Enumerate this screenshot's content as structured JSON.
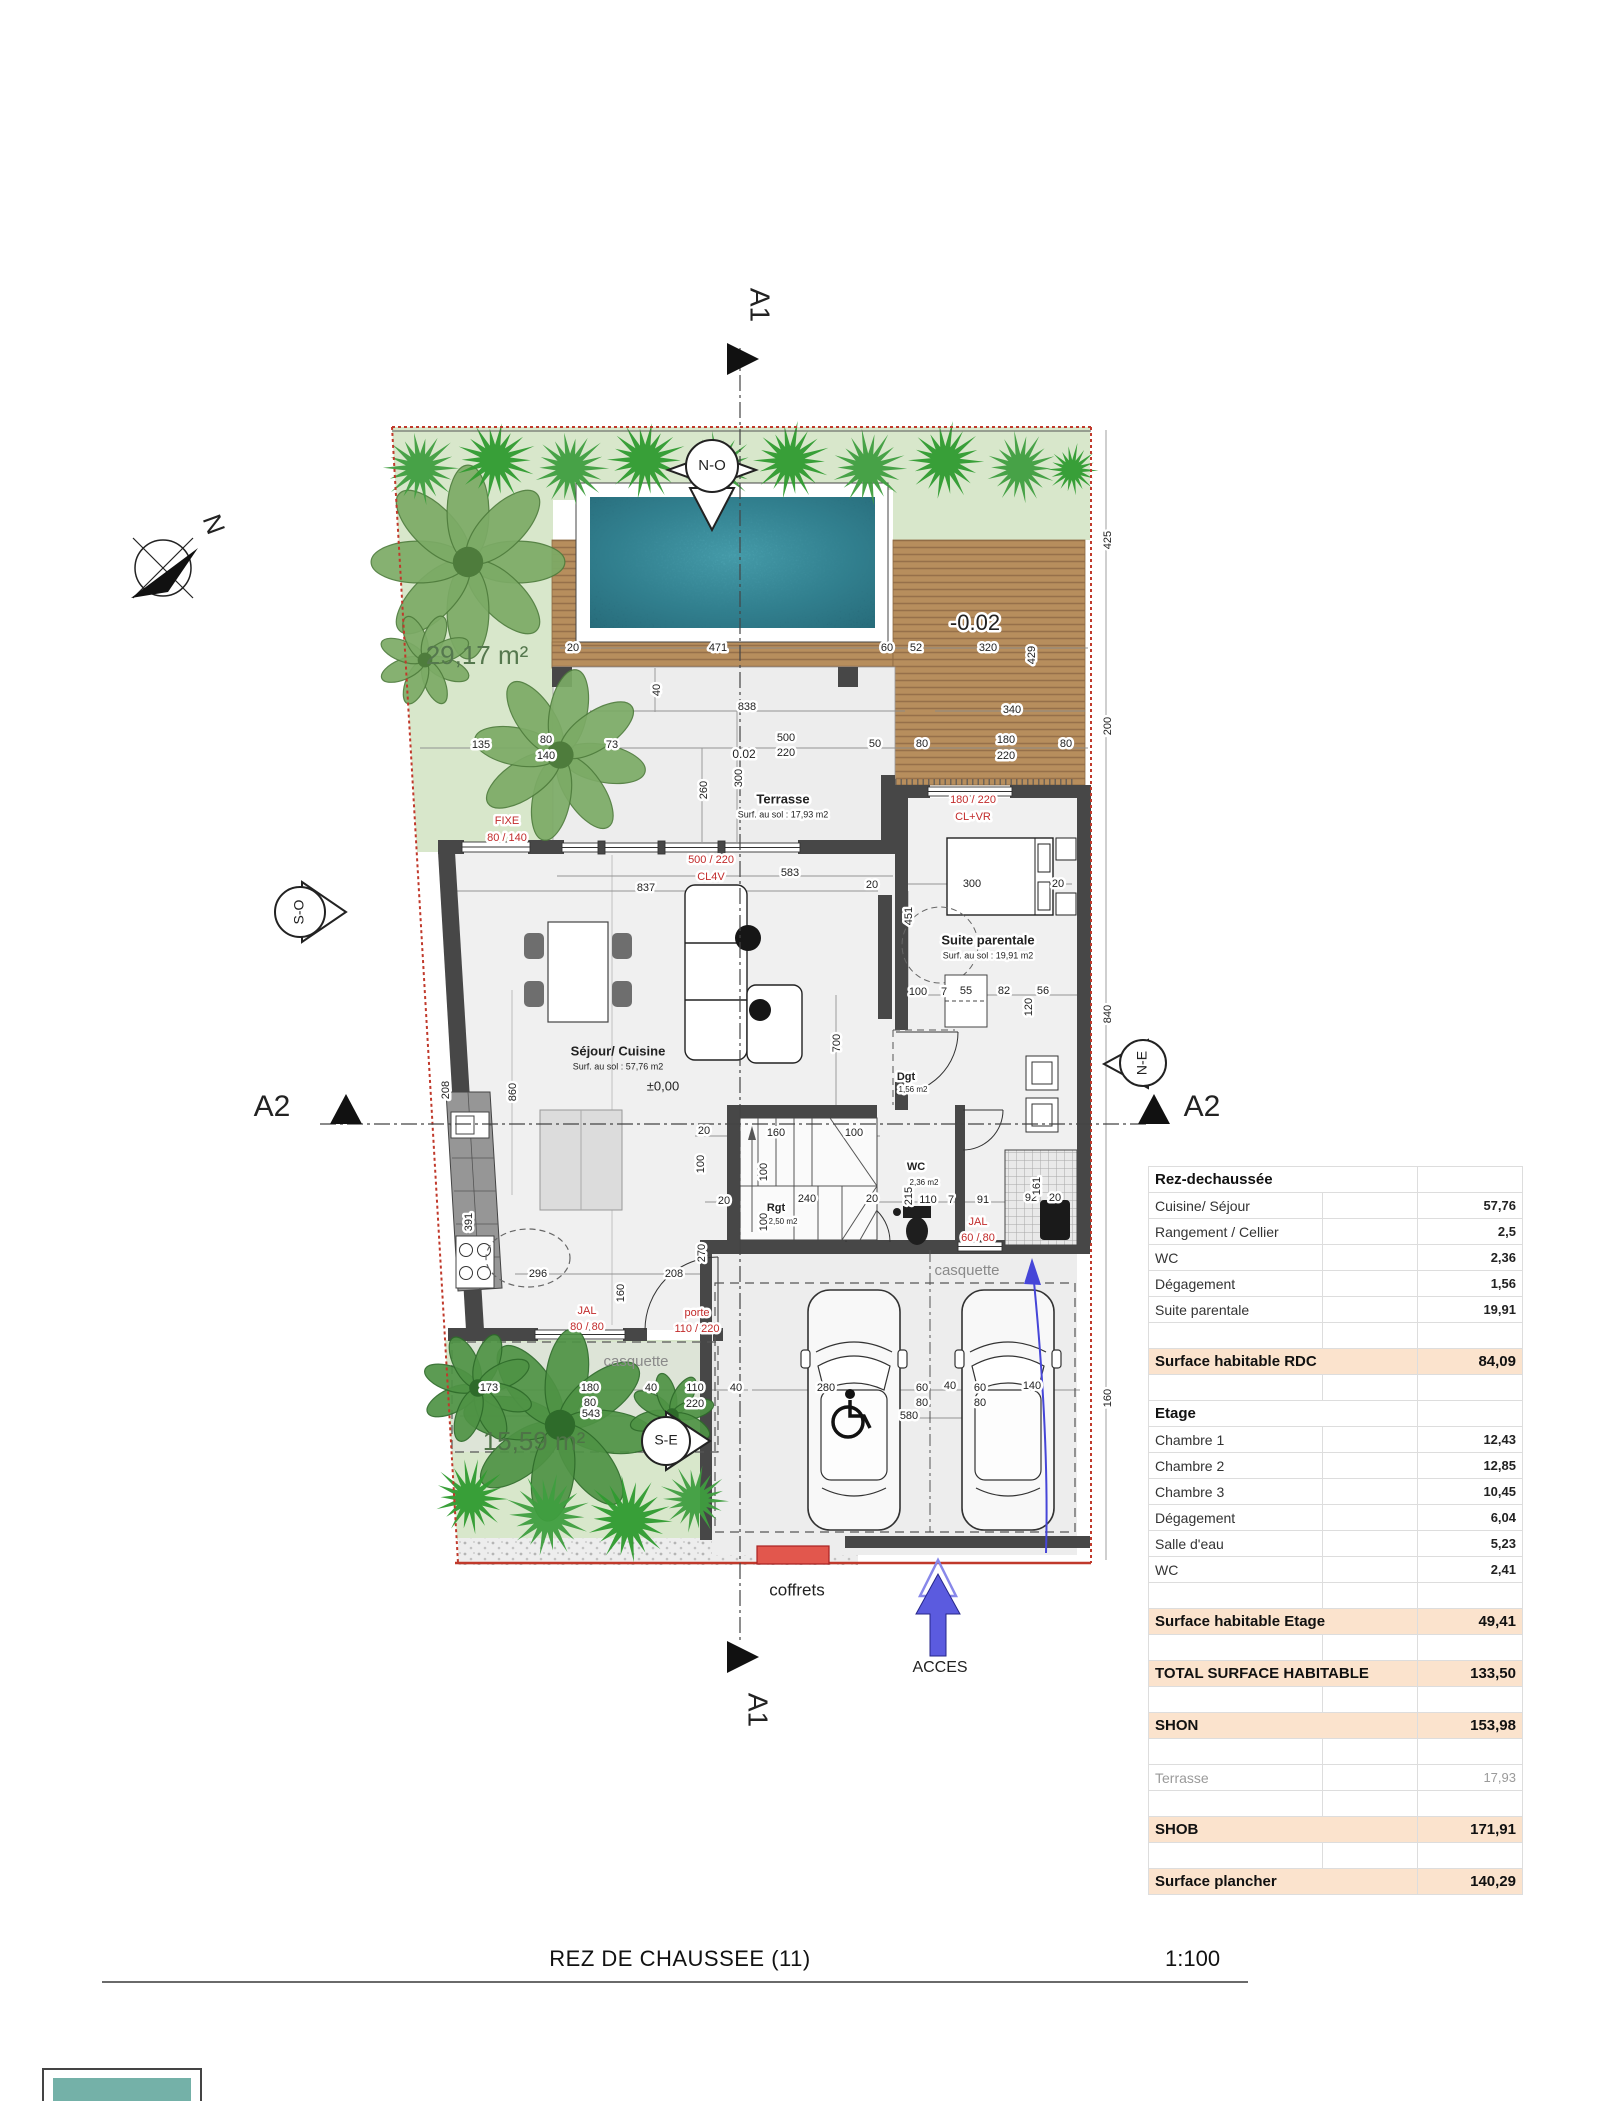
{
  "document": {
    "title": "REZ DE CHAUSSEE (11)",
    "scale": "1:100"
  },
  "surface_table": {
    "rows": [
      {
        "label": "Rez-dechaussée",
        "value": "",
        "style": "header"
      },
      {
        "label": "Cuisine/ Séjour",
        "value": "57,76",
        "style": "normal"
      },
      {
        "label": "Rangement / Cellier",
        "value": "2,5",
        "style": "normal"
      },
      {
        "label": "WC",
        "value": "2,36",
        "style": "normal"
      },
      {
        "label": "Dégagement",
        "value": "1,56",
        "style": "normal"
      },
      {
        "label": "Suite parentale",
        "value": "19,91",
        "style": "normal"
      },
      {
        "label": "",
        "value": "",
        "style": "blank"
      },
      {
        "label": "Surface habitable RDC",
        "value": "84,09",
        "style": "total"
      },
      {
        "label": "",
        "value": "",
        "style": "blank"
      },
      {
        "label": "Etage",
        "value": "",
        "style": "header"
      },
      {
        "label": "Chambre 1",
        "value": "12,43",
        "style": "normal"
      },
      {
        "label": "Chambre 2",
        "value": "12,85",
        "style": "normal"
      },
      {
        "label": "Chambre 3",
        "value": "10,45",
        "style": "normal"
      },
      {
        "label": "Dégagement",
        "value": "6,04",
        "style": "normal"
      },
      {
        "label": "Salle d'eau",
        "value": "5,23",
        "style": "normal"
      },
      {
        "label": "WC",
        "value": "2,41",
        "style": "normal"
      },
      {
        "label": "",
        "value": "",
        "style": "blank"
      },
      {
        "label": "Surface habitable Etage",
        "value": "49,41",
        "style": "total"
      },
      {
        "label": "",
        "value": "",
        "style": "blank"
      },
      {
        "label": "TOTAL SURFACE HABITABLE",
        "value": "133,50",
        "style": "total"
      },
      {
        "label": "",
        "value": "",
        "style": "blank"
      },
      {
        "label": "SHON",
        "value": "153,98",
        "style": "total"
      },
      {
        "label": "",
        "value": "",
        "style": "blank"
      },
      {
        "label": "Terrasse",
        "value": "17,93",
        "style": "muted"
      },
      {
        "label": "",
        "value": "",
        "style": "blank"
      },
      {
        "label": "SHOB",
        "value": "171,91",
        "style": "total"
      },
      {
        "label": "",
        "value": "",
        "style": "blank"
      },
      {
        "label": "Surface plancher",
        "value": "140,29",
        "style": "total"
      }
    ]
  },
  "plan": {
    "labels": [
      {
        "t": "A1",
        "x": 758,
        "y": 305,
        "s": 28,
        "r": 90
      },
      {
        "t": "A1",
        "x": 756,
        "y": 1710,
        "s": 28,
        "r": 90
      },
      {
        "t": "A2",
        "x": 272,
        "y": 1108,
        "s": 30
      },
      {
        "t": "A2",
        "x": 1202,
        "y": 1108,
        "s": 30
      },
      {
        "t": "N",
        "x": 212,
        "y": 525,
        "s": 26,
        "r": 70
      },
      {
        "t": "N-O",
        "x": 712,
        "y": 466,
        "s": 15
      },
      {
        "t": "S-O",
        "x": 300,
        "y": 912,
        "s": 14,
        "r": -90
      },
      {
        "t": "N-E",
        "x": 1143,
        "y": 1063,
        "s": 14,
        "r": -90
      },
      {
        "t": "S-E",
        "x": 666,
        "y": 1441,
        "s": 14
      },
      {
        "t": "Terrasse",
        "x": 783,
        "y": 800,
        "s": 13,
        "b": 1,
        "h": 1
      },
      {
        "t": "Surf. au sol : 17,93 m2",
        "x": 783,
        "y": 815,
        "s": 9,
        "h": 1
      },
      {
        "t": "Séjour/ Cuisine",
        "x": 618,
        "y": 1052,
        "s": 13,
        "b": 1
      },
      {
        "t": "Surf. au sol : 57,76 m2",
        "x": 618,
        "y": 1067,
        "s": 9
      },
      {
        "t": "Suite parentale",
        "x": 988,
        "y": 941,
        "s": 13,
        "b": 1,
        "h": 1
      },
      {
        "t": "Surf. au sol : 19,91 m2",
        "x": 988,
        "y": 956,
        "s": 9,
        "h": 1
      },
      {
        "t": "Dgt",
        "x": 906,
        "y": 1077,
        "s": 11,
        "b": 1,
        "h": 1
      },
      {
        "t": "1,56 m2",
        "x": 913,
        "y": 1090,
        "s": 8,
        "h": 1
      },
      {
        "t": "WC",
        "x": 916,
        "y": 1167,
        "s": 11,
        "b": 1,
        "h": 1
      },
      {
        "t": "2,36 m2",
        "x": 924,
        "y": 1183,
        "s": 8,
        "h": 1
      },
      {
        "t": "Rgt",
        "x": 776,
        "y": 1208,
        "s": 11,
        "b": 1,
        "h": 1
      },
      {
        "t": "2,50 m2",
        "x": 783,
        "y": 1222,
        "s": 8,
        "h": 1
      },
      {
        "t": "casquette",
        "x": 636,
        "y": 1362,
        "s": 15,
        "c": "#8a8a8a"
      },
      {
        "t": "casquette",
        "x": 967,
        "y": 1271,
        "s": 15,
        "c": "#8a8a8a"
      },
      {
        "t": "29,17 m²",
        "x": 477,
        "y": 657,
        "s": 26,
        "c": "#55784e"
      },
      {
        "t": "15,59 m²",
        "x": 534,
        "y": 1443,
        "s": 26,
        "c": "#4e7347"
      },
      {
        "t": "±0,00",
        "x": 663,
        "y": 1087,
        "s": 13
      },
      {
        "t": "-0.02",
        "x": 975,
        "y": 624,
        "s": 22,
        "h": 1
      },
      {
        "t": "0.02",
        "x": 744,
        "y": 755,
        "s": 12,
        "h": 1
      },
      {
        "t": "coffrets",
        "x": 797,
        "y": 1591,
        "s": 17
      },
      {
        "t": "ACCES",
        "x": 940,
        "y": 1668,
        "s": 16
      },
      {
        "t": "FIXE",
        "x": 507,
        "y": 821,
        "s": 11,
        "c": "#c22b2b",
        "h": 1
      },
      {
        "t": "80 / 140",
        "x": 507,
        "y": 838,
        "s": 11,
        "c": "#c22b2b",
        "h": 1
      },
      {
        "t": "500 / 220",
        "x": 711,
        "y": 860,
        "s": 11,
        "c": "#c22b2b",
        "h": 1
      },
      {
        "t": "CL4V",
        "x": 711,
        "y": 877,
        "s": 11,
        "c": "#c22b2b",
        "h": 1
      },
      {
        "t": "180 / 220",
        "x": 973,
        "y": 800,
        "s": 11,
        "c": "#c22b2b",
        "h": 1
      },
      {
        "t": "CL+VR",
        "x": 973,
        "y": 817,
        "s": 11,
        "c": "#c22b2b",
        "h": 1
      },
      {
        "t": "JAL",
        "x": 587,
        "y": 1311,
        "s": 11,
        "c": "#c22b2b",
        "h": 1
      },
      {
        "t": "80 / 80",
        "x": 587,
        "y": 1327,
        "s": 11,
        "c": "#c22b2b",
        "h": 1
      },
      {
        "t": "JAL",
        "x": 978,
        "y": 1222,
        "s": 11,
        "c": "#c22b2b",
        "h": 1
      },
      {
        "t": "60 / 80",
        "x": 978,
        "y": 1238,
        "s": 11,
        "c": "#c22b2b",
        "h": 1
      },
      {
        "t": "porte",
        "x": 697,
        "y": 1313,
        "s": 11,
        "c": "#c22b2b",
        "h": 1
      },
      {
        "t": "110 / 220",
        "x": 697,
        "y": 1329,
        "s": 11,
        "c": "#c22b2b",
        "h": 1
      },
      {
        "t": "20",
        "x": 573,
        "y": 648,
        "s": 11,
        "h": 1
      },
      {
        "t": "471",
        "x": 718,
        "y": 648,
        "s": 11,
        "h": 1
      },
      {
        "t": "60",
        "x": 887,
        "y": 648,
        "s": 11,
        "h": 1
      },
      {
        "t": "52",
        "x": 916,
        "y": 648,
        "s": 11,
        "h": 1
      },
      {
        "t": "320",
        "x": 988,
        "y": 648,
        "s": 11,
        "h": 1
      },
      {
        "t": "429",
        "x": 1032,
        "y": 655,
        "s": 11,
        "r": -90,
        "h": 1
      },
      {
        "t": "425",
        "x": 1108,
        "y": 540,
        "s": 11,
        "r": -90,
        "h": 1
      },
      {
        "t": "200",
        "x": 1108,
        "y": 726,
        "s": 11,
        "r": -90,
        "h": 1
      },
      {
        "t": "840",
        "x": 1108,
        "y": 1014,
        "s": 11,
        "r": -90,
        "h": 1
      },
      {
        "t": "160",
        "x": 1108,
        "y": 1398,
        "s": 11,
        "r": -90,
        "h": 1
      },
      {
        "t": "838",
        "x": 747,
        "y": 707,
        "s": 11,
        "h": 1
      },
      {
        "t": "340",
        "x": 1012,
        "y": 710,
        "s": 11,
        "h": 1
      },
      {
        "t": "40",
        "x": 657,
        "y": 690,
        "s": 11,
        "r": -90,
        "h": 1
      },
      {
        "t": "135",
        "x": 481,
        "y": 745,
        "s": 11,
        "h": 1
      },
      {
        "t": "80",
        "x": 546,
        "y": 740,
        "s": 11,
        "h": 1
      },
      {
        "t": "140",
        "x": 546,
        "y": 756,
        "s": 11,
        "h": 1
      },
      {
        "t": "73",
        "x": 612,
        "y": 745,
        "s": 11,
        "h": 1
      },
      {
        "t": "500",
        "x": 786,
        "y": 738,
        "s": 11,
        "h": 1
      },
      {
        "t": "220",
        "x": 786,
        "y": 753,
        "s": 11,
        "h": 1
      },
      {
        "t": "50",
        "x": 875,
        "y": 744,
        "s": 11,
        "h": 1
      },
      {
        "t": "80",
        "x": 922,
        "y": 744,
        "s": 11,
        "h": 1
      },
      {
        "t": "180",
        "x": 1006,
        "y": 740,
        "s": 11,
        "h": 1
      },
      {
        "t": "220",
        "x": 1006,
        "y": 756,
        "s": 11,
        "h": 1
      },
      {
        "t": "80",
        "x": 1066,
        "y": 744,
        "s": 11,
        "h": 1
      },
      {
        "t": "260",
        "x": 704,
        "y": 790,
        "s": 11,
        "r": -90,
        "h": 1
      },
      {
        "t": "300",
        "x": 739,
        "y": 778,
        "s": 11,
        "r": -90,
        "h": 1
      },
      {
        "t": "583",
        "x": 790,
        "y": 873,
        "s": 11,
        "h": 1
      },
      {
        "t": "837",
        "x": 646,
        "y": 888,
        "s": 11,
        "h": 1
      },
      {
        "t": "20",
        "x": 872,
        "y": 885,
        "s": 11,
        "h": 1
      },
      {
        "t": "300",
        "x": 972,
        "y": 884,
        "s": 11,
        "h": 1
      },
      {
        "t": "20",
        "x": 1058,
        "y": 884,
        "s": 11,
        "h": 1
      },
      {
        "t": "451",
        "x": 909,
        "y": 916,
        "s": 11,
        "r": -90,
        "h": 1
      },
      {
        "t": "700",
        "x": 837,
        "y": 1043,
        "s": 11,
        "r": -90,
        "h": 1
      },
      {
        "t": "100",
        "x": 918,
        "y": 992,
        "s": 11,
        "h": 1
      },
      {
        "t": "7",
        "x": 944,
        "y": 992,
        "s": 11,
        "h": 1
      },
      {
        "t": "55",
        "x": 966,
        "y": 991,
        "s": 11,
        "h": 1
      },
      {
        "t": "82",
        "x": 1004,
        "y": 991,
        "s": 11,
        "h": 1
      },
      {
        "t": "56",
        "x": 1043,
        "y": 991,
        "s": 11,
        "h": 1
      },
      {
        "t": "120",
        "x": 1029,
        "y": 1007,
        "s": 11,
        "r": -90,
        "h": 1
      },
      {
        "t": "860",
        "x": 513,
        "y": 1092,
        "s": 11,
        "r": -90,
        "h": 1
      },
      {
        "t": "208",
        "x": 446,
        "y": 1090,
        "s": 11,
        "r": -90,
        "h": 1
      },
      {
        "t": "391",
        "x": 469,
        "y": 1222,
        "s": 11,
        "r": -90,
        "h": 1
      },
      {
        "t": "20",
        "x": 704,
        "y": 1131,
        "s": 11,
        "h": 1
      },
      {
        "t": "160",
        "x": 776,
        "y": 1133,
        "s": 11,
        "h": 1
      },
      {
        "t": "100",
        "x": 854,
        "y": 1133,
        "s": 11,
        "h": 1
      },
      {
        "t": "100",
        "x": 701,
        "y": 1164,
        "s": 11,
        "r": -90,
        "h": 1
      },
      {
        "t": "100",
        "x": 764,
        "y": 1172,
        "s": 11,
        "r": -90,
        "h": 1
      },
      {
        "t": "100",
        "x": 764,
        "y": 1222,
        "s": 11,
        "r": -90,
        "h": 1
      },
      {
        "t": "240",
        "x": 807,
        "y": 1199,
        "s": 11,
        "h": 1
      },
      {
        "t": "20",
        "x": 872,
        "y": 1199,
        "s": 11,
        "h": 1
      },
      {
        "t": "20",
        "x": 724,
        "y": 1201,
        "s": 11,
        "h": 1
      },
      {
        "t": "110",
        "x": 928,
        "y": 1200,
        "s": 11,
        "h": 1
      },
      {
        "t": "7",
        "x": 951,
        "y": 1200,
        "s": 11,
        "h": 1
      },
      {
        "t": "91",
        "x": 983,
        "y": 1200,
        "s": 11,
        "h": 1
      },
      {
        "t": "92",
        "x": 1031,
        "y": 1198,
        "s": 11,
        "h": 1
      },
      {
        "t": "20",
        "x": 1055,
        "y": 1198,
        "s": 11,
        "h": 1
      },
      {
        "t": "215",
        "x": 909,
        "y": 1196,
        "s": 11,
        "r": -90,
        "h": 1
      },
      {
        "t": "161",
        "x": 1037,
        "y": 1186,
        "s": 11,
        "r": -90,
        "h": 1
      },
      {
        "t": "296",
        "x": 538,
        "y": 1274,
        "s": 11,
        "h": 1
      },
      {
        "t": "208",
        "x": 674,
        "y": 1274,
        "s": 11,
        "h": 1
      },
      {
        "t": "270",
        "x": 702,
        "y": 1253,
        "s": 11,
        "r": -90,
        "h": 1
      },
      {
        "t": "160",
        "x": 621,
        "y": 1293,
        "s": 11,
        "r": -90,
        "h": 1
      },
      {
        "t": "173",
        "x": 489,
        "y": 1388,
        "s": 11,
        "h": 1
      },
      {
        "t": "180",
        "x": 590,
        "y": 1388,
        "s": 11,
        "h": 1
      },
      {
        "t": "80",
        "x": 590,
        "y": 1403,
        "s": 11,
        "h": 1
      },
      {
        "t": "40",
        "x": 651,
        "y": 1388,
        "s": 11,
        "h": 1
      },
      {
        "t": "110",
        "x": 695,
        "y": 1388,
        "s": 11,
        "h": 1
      },
      {
        "t": "220",
        "x": 695,
        "y": 1404,
        "s": 11,
        "h": 1
      },
      {
        "t": "40",
        "x": 736,
        "y": 1388,
        "s": 11,
        "h": 1
      },
      {
        "t": "543",
        "x": 591,
        "y": 1414,
        "s": 11,
        "h": 1
      },
      {
        "t": "280",
        "x": 826,
        "y": 1388,
        "s": 11,
        "h": 1
      },
      {
        "t": "60",
        "x": 922,
        "y": 1388,
        "s": 11,
        "h": 1
      },
      {
        "t": "80",
        "x": 922,
        "y": 1403,
        "s": 11,
        "h": 1
      },
      {
        "t": "40",
        "x": 950,
        "y": 1386,
        "s": 11,
        "h": 1
      },
      {
        "t": "60",
        "x": 980,
        "y": 1388,
        "s": 11,
        "h": 1
      },
      {
        "t": "80",
        "x": 980,
        "y": 1403,
        "s": 11,
        "h": 1
      },
      {
        "t": "140",
        "x": 1032,
        "y": 1386,
        "s": 11,
        "h": 1
      },
      {
        "t": "580",
        "x": 909,
        "y": 1416,
        "s": 11,
        "h": 1
      }
    ]
  }
}
